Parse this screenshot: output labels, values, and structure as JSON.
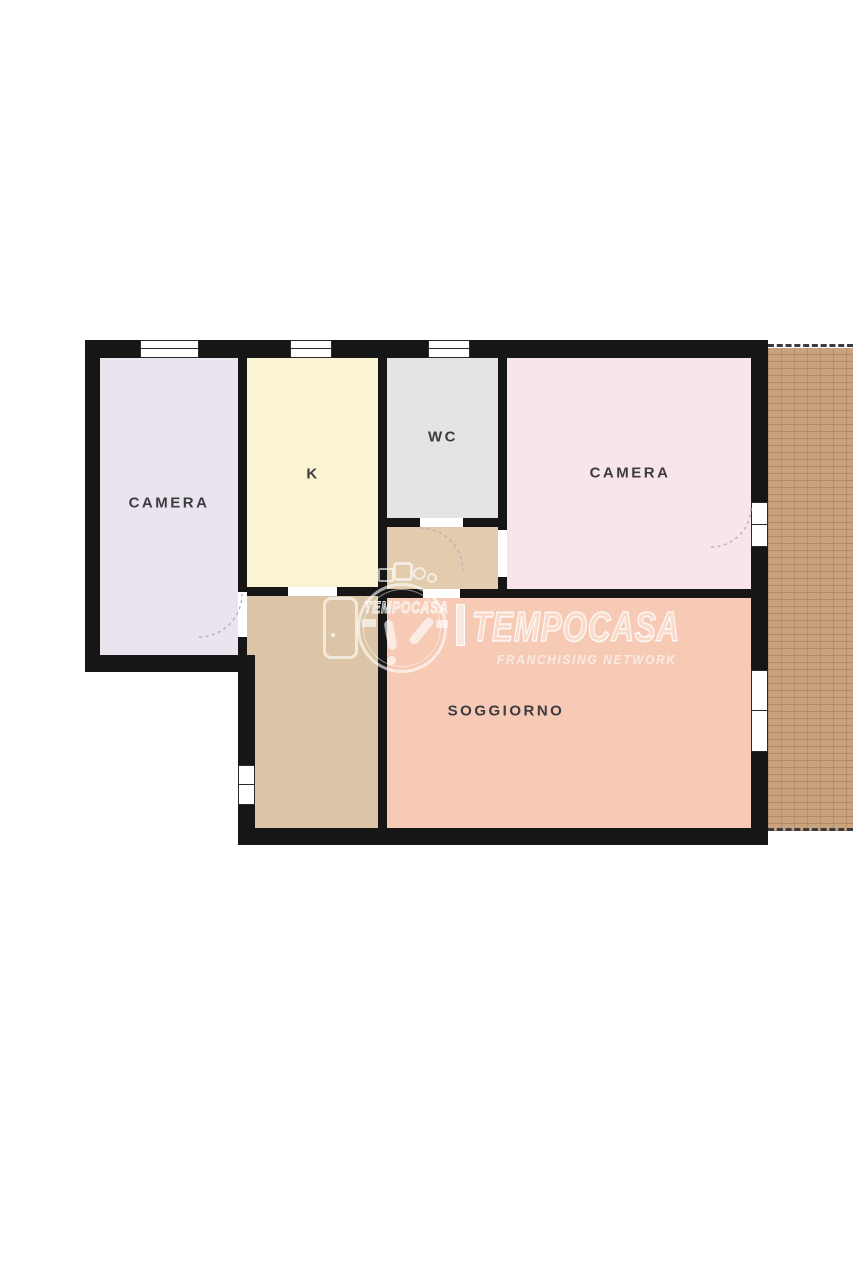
{
  "colors": {
    "page_bg": "#ffffff",
    "wall": "#161616",
    "frame": "#2a2a2a",
    "label": "#3b3b40",
    "camera_left": "#e9e4ee",
    "kitchen": "#fbf4d3",
    "wc": "#e3e5e2",
    "camera_right": "#f8e4eb",
    "vestibule": "#e3ccae",
    "hallway": "#dcc5a7",
    "soggiorno": "#f6cab5",
    "terrace_base": "#c9a380",
    "terrace_border": "#3b3b3b",
    "arc": "#b7b0bc"
  },
  "floorplan": {
    "rooms": {
      "camera_left": {
        "label": "CAMERA"
      },
      "kitchen": {
        "label": "K"
      },
      "wc": {
        "label": "WC"
      },
      "camera_right": {
        "label": "CAMERA"
      },
      "soggiorno": {
        "label": "SOGGIORNO"
      }
    }
  },
  "watermark": {
    "brand": "TEMPOCASA",
    "brand_small": "TEMPOCASA",
    "trademark": "™",
    "subtitle": "FRANCHISING NETWORK"
  }
}
